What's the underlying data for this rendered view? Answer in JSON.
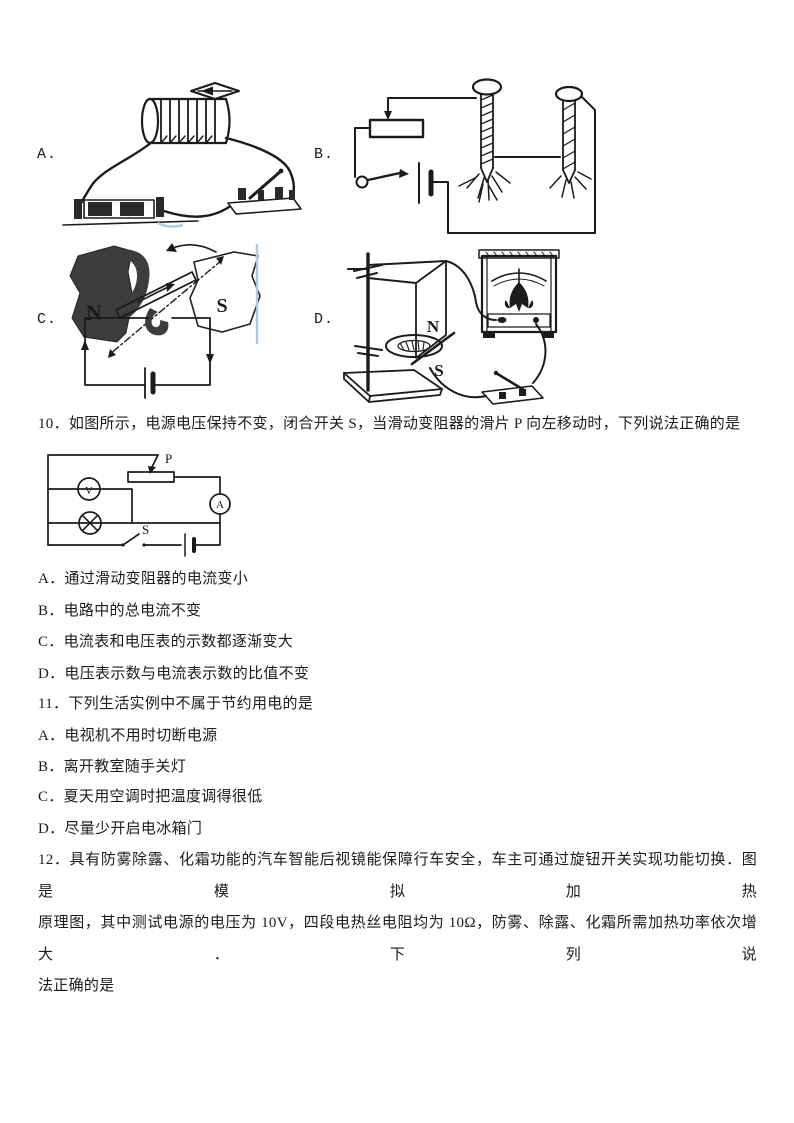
{
  "figures": {
    "a": {
      "label": "A."
    },
    "b": {
      "label": "B."
    },
    "c": {
      "label": "C.",
      "n": "N",
      "s": "S"
    },
    "d": {
      "label": "D.",
      "n": "N",
      "s": "S"
    }
  },
  "q10": {
    "stem": "10．如图所示，电源电压保持不变，闭合开关 S，当滑动变阻器的滑片 P 向左移动时，下列说法正确的是",
    "circuit": {
      "slider_label": "P",
      "switch_label": "S",
      "voltmeter_label": "V",
      "ammeter_label": "A"
    },
    "options": [
      "A．通过滑动变阻器的电流变小",
      "B．电路中的总电流不变",
      "C．电流表和电压表的示数都逐渐变大",
      "D．电压表示数与电流表示数的比值不变"
    ]
  },
  "q11": {
    "stem": "11．下列生活实例中不属于节约用电的是",
    "options": [
      "A．电视机不用时切断电源",
      "B．离开教室随手关灯",
      "C．夏天用空调时把温度调得很低",
      "D．尽量少开启电冰箱门"
    ]
  },
  "q12": {
    "lines": [
      "12．具有防雾除露、化霜功能的汽车智能后视镜能保障行车安全，车主可通过旋钮开关实现功能切换．图是模拟加热",
      "原理图，其中测试电源的电压为 10V，四段电热丝电阻均为 10Ω，防雾、除露、化霜所需加热功率依次增大．下列说",
      "法正确的是"
    ]
  },
  "colors": {
    "ink": "#1b1b1b",
    "scan_artifact_blue": "#a9cdea"
  }
}
